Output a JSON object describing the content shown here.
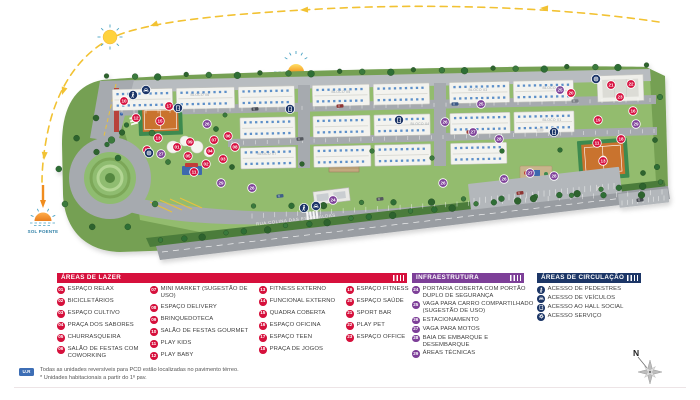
{
  "colors": {
    "lazer": "#D6103C",
    "infra": "#7D3F98",
    "circ": "#1C3667",
    "sun_path": "#F2C233",
    "sun_setting": "#F08C1E",
    "note_tag": "#3D6EB5"
  },
  "map": {
    "street": "RUA COLINA DAS ESMERALDAS",
    "compass": "N",
    "sun_rising_label": "SOL NASCENTE",
    "sun_setting_label": "SOL POENTE",
    "blocks": [
      {
        "label": "BLOCO 06",
        "x": 200,
        "y": 96
      },
      {
        "label": "BLOCO 05",
        "x": 341,
        "y": 93
      },
      {
        "label": "BLOCO 03",
        "x": 478,
        "y": 91
      },
      {
        "label": "BLOCO 02",
        "x": 552,
        "y": 89
      },
      {
        "label": "BLOCO 04",
        "x": 420,
        "y": 125
      },
      {
        "label": "BLOCO 01",
        "x": 552,
        "y": 121
      },
      {
        "label": "BLOCO 07",
        "x": 267,
        "y": 155
      }
    ],
    "badges": [
      {
        "n": "10",
        "t": "lazer",
        "x": 124,
        "y": 101
      },
      {
        "n": "17",
        "t": "lazer",
        "x": 169,
        "y": 106
      },
      {
        "n": "12",
        "t": "lazer",
        "x": 136,
        "y": 118
      },
      {
        "n": "15",
        "t": "lazer",
        "x": 160,
        "y": 121
      },
      {
        "n": "13",
        "t": "lazer",
        "x": 158,
        "y": 138
      },
      {
        "n": "14",
        "t": "lazer",
        "x": 147,
        "y": 150
      },
      {
        "n": "01",
        "t": "lazer",
        "x": 177,
        "y": 147
      },
      {
        "n": "09",
        "t": "lazer",
        "x": 190,
        "y": 142
      },
      {
        "n": "05",
        "t": "lazer",
        "x": 188,
        "y": 156
      },
      {
        "n": "04",
        "t": "lazer",
        "x": 210,
        "y": 151
      },
      {
        "n": "02",
        "t": "lazer",
        "x": 206,
        "y": 164
      },
      {
        "n": "03",
        "t": "lazer",
        "x": 223,
        "y": 159
      },
      {
        "n": "06",
        "t": "lazer",
        "x": 228,
        "y": 136
      },
      {
        "n": "07",
        "t": "lazer",
        "x": 214,
        "y": 140
      },
      {
        "n": "08",
        "t": "lazer",
        "x": 235,
        "y": 147
      },
      {
        "n": "11",
        "t": "lazer",
        "x": 194,
        "y": 172
      },
      {
        "n": "18",
        "t": "lazer",
        "x": 621,
        "y": 139
      },
      {
        "n": "11",
        "t": "lazer",
        "x": 597,
        "y": 143
      },
      {
        "n": "13",
        "t": "lazer",
        "x": 603,
        "y": 161
      },
      {
        "n": "19",
        "t": "lazer",
        "x": 598,
        "y": 120
      },
      {
        "n": "16",
        "t": "lazer",
        "x": 633,
        "y": 111
      },
      {
        "n": "20",
        "t": "lazer",
        "x": 571,
        "y": 93
      },
      {
        "n": "21",
        "t": "lazer",
        "x": 611,
        "y": 85
      },
      {
        "n": "22",
        "t": "lazer",
        "x": 631,
        "y": 84
      },
      {
        "n": "23",
        "t": "lazer",
        "x": 620,
        "y": 97
      },
      {
        "n": "24",
        "t": "infra",
        "x": 333,
        "y": 200
      },
      {
        "n": "25",
        "t": "infra",
        "x": 481,
        "y": 104
      },
      {
        "n": "25",
        "t": "infra",
        "x": 560,
        "y": 90
      },
      {
        "n": "26",
        "t": "infra",
        "x": 207,
        "y": 124
      },
      {
        "n": "26",
        "t": "infra",
        "x": 445,
        "y": 122
      },
      {
        "n": "26",
        "t": "infra",
        "x": 504,
        "y": 179
      },
      {
        "n": "26",
        "t": "infra",
        "x": 443,
        "y": 183
      },
      {
        "n": "26",
        "t": "infra",
        "x": 252,
        "y": 188
      },
      {
        "n": "27",
        "t": "infra",
        "x": 161,
        "y": 154
      },
      {
        "n": "27",
        "t": "infra",
        "x": 473,
        "y": 132
      },
      {
        "n": "27",
        "t": "infra",
        "x": 530,
        "y": 173
      },
      {
        "n": "28",
        "t": "infra",
        "x": 499,
        "y": 139
      },
      {
        "n": "28",
        "t": "infra",
        "x": 554,
        "y": 176
      },
      {
        "n": "29",
        "t": "infra",
        "x": 221,
        "y": 183
      },
      {
        "n": "29",
        "t": "infra",
        "x": 636,
        "y": 124
      },
      {
        "i": "vehicle",
        "t": "circ",
        "x": 316,
        "y": 206
      },
      {
        "i": "pedestrian",
        "t": "circ",
        "x": 304,
        "y": 208
      },
      {
        "i": "vehicle",
        "t": "circ",
        "x": 146,
        "y": 90
      },
      {
        "i": "pedestrian",
        "t": "circ",
        "x": 133,
        "y": 95
      },
      {
        "i": "hall",
        "t": "circ",
        "x": 178,
        "y": 108
      },
      {
        "i": "hall",
        "t": "circ",
        "x": 290,
        "y": 109
      },
      {
        "i": "hall",
        "t": "circ",
        "x": 399,
        "y": 120
      },
      {
        "i": "hall",
        "t": "circ",
        "x": 554,
        "y": 132
      },
      {
        "i": "service",
        "t": "circ",
        "x": 149,
        "y": 153
      },
      {
        "i": "service",
        "t": "circ",
        "x": 596,
        "y": 79
      }
    ]
  },
  "legend": {
    "lazer": {
      "title": "ÁREAS DE LAZER",
      "columns": [
        [
          {
            "n": "01",
            "label": "ESPAÇO RELAX"
          },
          {
            "n": "02",
            "label": "BICICLETÁRIOS"
          },
          {
            "n": "03",
            "label": "ESPAÇO CULTIVO"
          },
          {
            "n": "04",
            "label": "PRAÇA DOS SABORES"
          },
          {
            "n": "05",
            "label": "CHURRASQUEIRA"
          },
          {
            "n": "06",
            "label": "SALÃO DE FESTAS COM COWORKING"
          }
        ],
        [
          {
            "n": "07",
            "label": "MINI MARKET (SUGESTÃO DE USO)"
          },
          {
            "n": "08",
            "label": "ESPAÇO DELIVERY"
          },
          {
            "n": "09",
            "label": "BRINQUEDOTECA"
          },
          {
            "n": "10",
            "label": "SALÃO DE FESTAS GOURMET"
          },
          {
            "n": "11",
            "label": "PLAY KIDS"
          },
          {
            "n": "12",
            "label": "PLAY BABY"
          }
        ],
        [
          {
            "n": "13",
            "label": "FITNESS EXTERNO"
          },
          {
            "n": "14",
            "label": "FUNCIONAL EXTERNO"
          },
          {
            "n": "15",
            "label": "QUADRA COBERTA"
          },
          {
            "n": "16",
            "label": "ESPAÇO OFICINA"
          },
          {
            "n": "17",
            "label": "ESPAÇO TEEN"
          },
          {
            "n": "18",
            "label": "PRAÇA DE JOGOS"
          }
        ],
        [
          {
            "n": "19",
            "label": "ESPAÇO FITNESS"
          },
          {
            "n": "20",
            "label": "ESPAÇO SAÚDE"
          },
          {
            "n": "21",
            "label": "SPORT BAR"
          },
          {
            "n": "22",
            "label": "PLAY PET"
          },
          {
            "n": "23",
            "label": "ESPAÇO OFFICE"
          }
        ]
      ]
    },
    "infra": {
      "title": "INFRAESTRUTURA",
      "items": [
        {
          "n": "24",
          "label": "PORTARIA COBERTA COM PORTÃO DUPLO DE SEGURANÇA"
        },
        {
          "n": "25",
          "label": "VAGA PARA CARRO COMPARTILHADO (SUGESTÃO DE USO)"
        },
        {
          "n": "26",
          "label": "ESTACIONAMENTO"
        },
        {
          "n": "27",
          "label": "VAGA PARA MOTOS"
        },
        {
          "n": "28",
          "label": "BAIA DE EMBARQUE E DESEMBARQUE"
        },
        {
          "n": "29",
          "label": "ÁREAS TÉCNICAS"
        }
      ]
    },
    "circ": {
      "title": "ÁREAS DE CIRCULAÇÃO",
      "items": [
        {
          "icon": "pedestrian",
          "label": "ACESSO DE PEDESTRES"
        },
        {
          "icon": "vehicle",
          "label": "ACESSO DE VEÍCULOS"
        },
        {
          "icon": "hall",
          "label": "ACESSO AO HALL SOCIAL"
        },
        {
          "icon": "service",
          "label": "ACESSO SERVIÇO"
        }
      ]
    }
  },
  "notes": {
    "tag": "U.R",
    "line1": "Todas as unidades reversíveis para PCD estão localizadas no pavimento térreo.",
    "line2": "* Unidades habitacionais a partir do 1º pav."
  }
}
